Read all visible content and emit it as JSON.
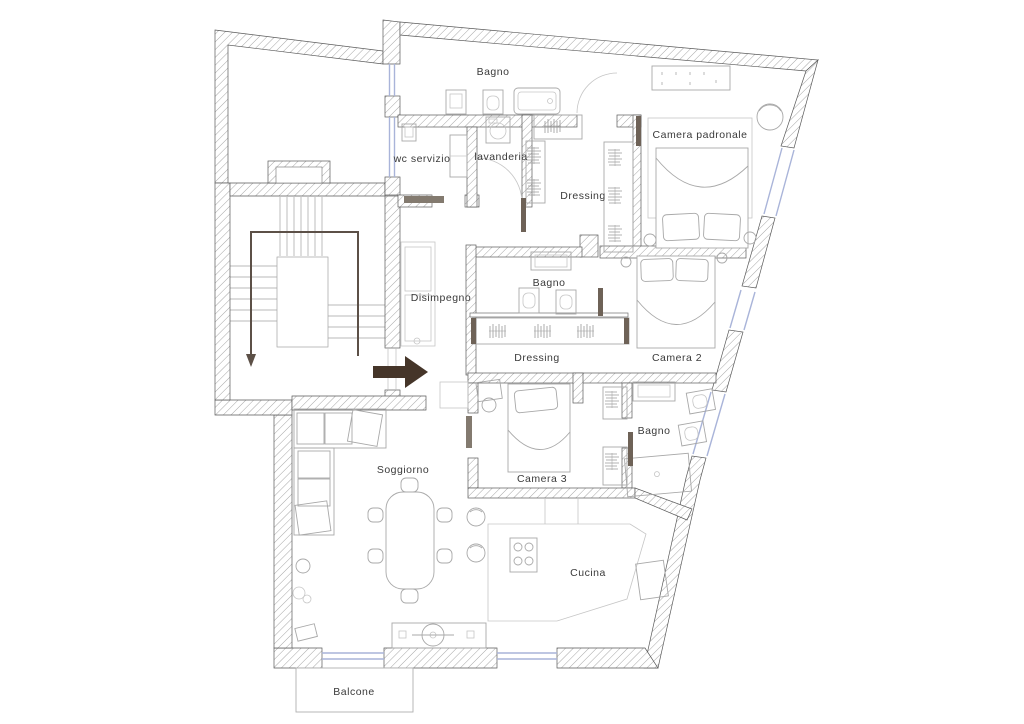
{
  "drawing": {
    "type": "apartment-floor-plan",
    "background": "#ffffff"
  },
  "colors": {
    "wall_outline": "#5a5a5a",
    "wall_hatch": "#8f8f8f",
    "furniture_line": "#a8a8a8",
    "window_glass": "#a9b4d9",
    "entrance_arrow": "#453529",
    "stair_arrow": "#5c5047",
    "label_text": "#3a3a3a"
  },
  "rooms": [
    {
      "id": "bagno-top",
      "label": "Bagno"
    },
    {
      "id": "camera-padronale",
      "label": "Camera padronale"
    },
    {
      "id": "wc-servizio",
      "label": "wc servizio"
    },
    {
      "id": "lavanderia",
      "label": "lavanderia"
    },
    {
      "id": "dressing-padronale",
      "label": "Dressing"
    },
    {
      "id": "disimpegno",
      "label": "Disimpegno"
    },
    {
      "id": "bagno-centrale",
      "label": "Bagno"
    },
    {
      "id": "dressing-notte",
      "label": "Dressing"
    },
    {
      "id": "camera-2",
      "label": "Camera 2"
    },
    {
      "id": "camera-3",
      "label": "Camera 3"
    },
    {
      "id": "bagno-camera-3",
      "label": "Bagno"
    },
    {
      "id": "soggiorno",
      "label": "Soggiorno"
    },
    {
      "id": "cucina",
      "label": "Cucina"
    },
    {
      "id": "balcone",
      "label": "Balcone"
    }
  ],
  "icons": {
    "entrance_arrow": "entrance-direction-right-arrow",
    "stair_direction": "stair-down-arrow"
  }
}
